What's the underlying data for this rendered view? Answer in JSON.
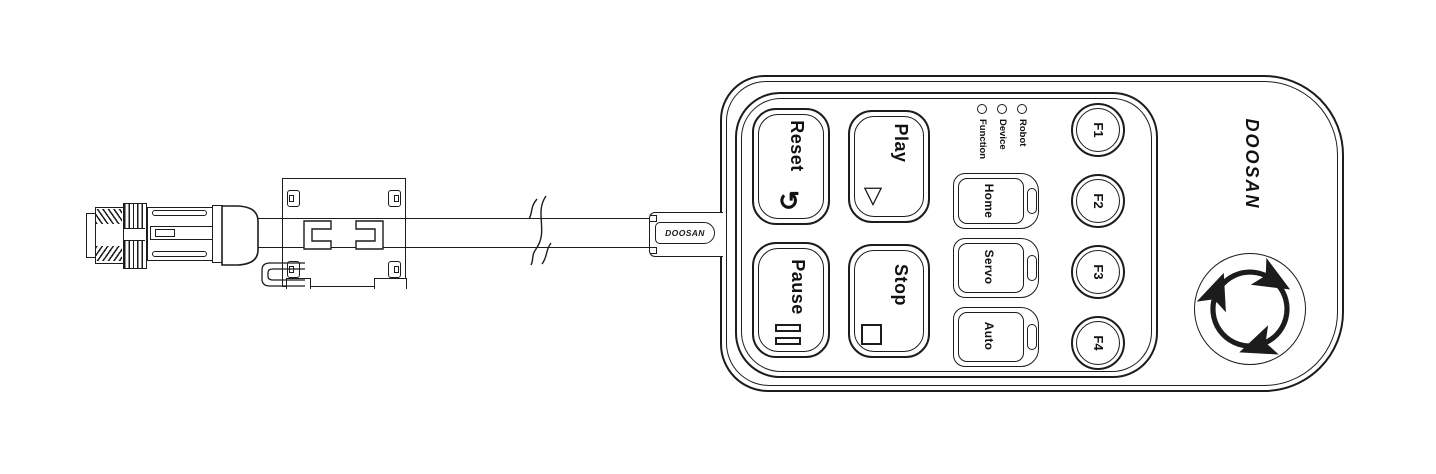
{
  "device": {
    "kind": "robot pendant cable diagram",
    "brand": "DOOSAN"
  },
  "cable": {
    "grommet_label": "DOOSAN",
    "parts": [
      "m12-connector",
      "threaded-tip",
      "knurled-nut",
      "connector-barrel",
      "ferrite-clamp",
      "cable-break-mark",
      "strain-relief-grommet"
    ]
  },
  "pendant": {
    "brand_logo": "DOOSAN",
    "buttons": {
      "reset": {
        "label": "Reset",
        "icon": "rotate-arrow"
      },
      "play": {
        "label": "Play",
        "icon": "triangle-outline"
      },
      "pause": {
        "label": "Pause",
        "icon": "double-bars"
      },
      "stop": {
        "label": "Stop",
        "icon": "square-outline"
      },
      "home": {
        "label": "Home"
      },
      "servo": {
        "label": "Servo"
      },
      "auto": {
        "label": "Auto"
      },
      "f1": {
        "label": "F1"
      },
      "f2": {
        "label": "F2"
      },
      "f3": {
        "label": "F3"
      },
      "f4": {
        "label": "F4"
      }
    },
    "leds": [
      {
        "label": "Robot"
      },
      {
        "label": "Device"
      },
      {
        "label": "Function"
      }
    ],
    "estop": {
      "icon": "rotate-release-arrows",
      "description": "emergency stop button"
    }
  },
  "icons": {
    "reset_glyph": "↺",
    "play_glyph": "▽"
  },
  "colors": {
    "line": "#1c1c1c",
    "background": "#ffffff"
  }
}
